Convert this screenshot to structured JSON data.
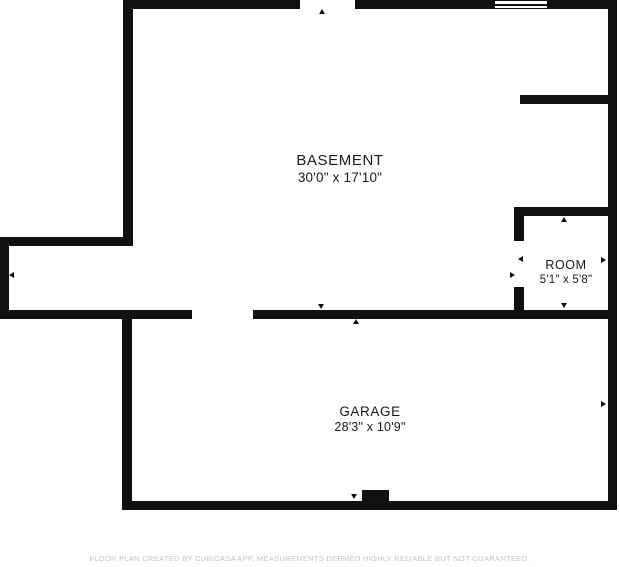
{
  "rooms": [
    {
      "name": "BASEMENT",
      "dimensions": "30'0\" x 17'10\""
    },
    {
      "name": "ROOM",
      "dimensions": "5'1\" x 5'8\""
    },
    {
      "name": "GARAGE",
      "dimensions": "28'3\" x 10'9\""
    }
  ],
  "footer": {
    "disclaimer": "FLOOR PLAN CREATED BY CUBICASA APP. MEASUREMENTS DEEMED HIGHLY RELIABLE BUT NOT GUARANTEED."
  },
  "symbols": {
    "window": "window-glyph",
    "opening_marker": "triangle-arrow"
  },
  "colors": {
    "wall": "#111111",
    "background": "#ffffff",
    "room_text": "#1a1a1a",
    "disclaimer_text": "#c5c5c5"
  }
}
